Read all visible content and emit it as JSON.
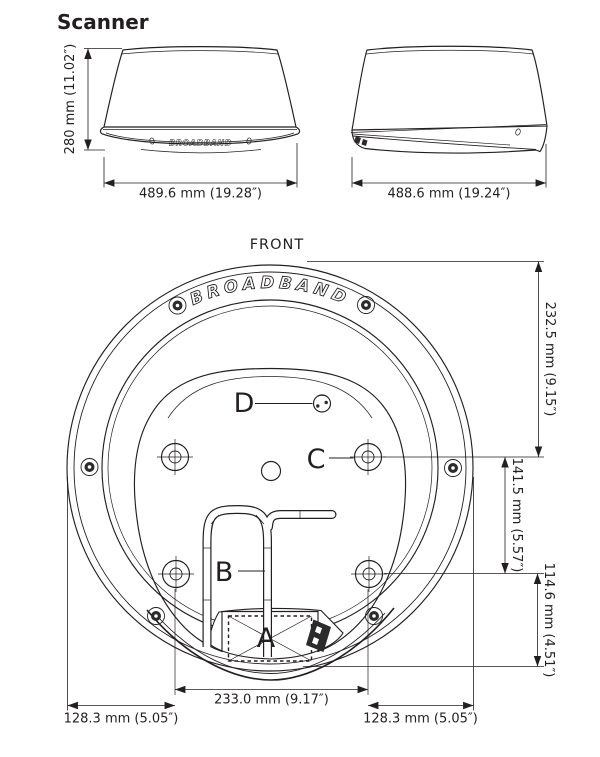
{
  "title": "Scanner",
  "front_view": {
    "height_dim": "280 mm (11.02″)",
    "width_dim": "489.6 mm (19.28″)",
    "brand": "BROADBAND"
  },
  "side_view": {
    "width_dim": "488.6 mm (19.24″)"
  },
  "bottom_view": {
    "orientation_label": "FRONT",
    "brand": "BROADBAND",
    "callout_a": "A",
    "callout_b": "B",
    "callout_c": "C",
    "callout_d": "D",
    "dim_top_to_bolts": "232.5 mm (9.15″)",
    "dim_bolt_vertical": "141.5 mm (5.57″)",
    "dim_bolts_to_bottom": "114.6 mm (4.51″)",
    "dim_bolt_width": "233.0 mm (9.17″)",
    "dim_left_offset": "128.3 mm (5.05″)",
    "dim_right_offset": "128.3 mm (5.05″)"
  },
  "colors": {
    "line": "#231f20",
    "background": "#ffffff"
  }
}
